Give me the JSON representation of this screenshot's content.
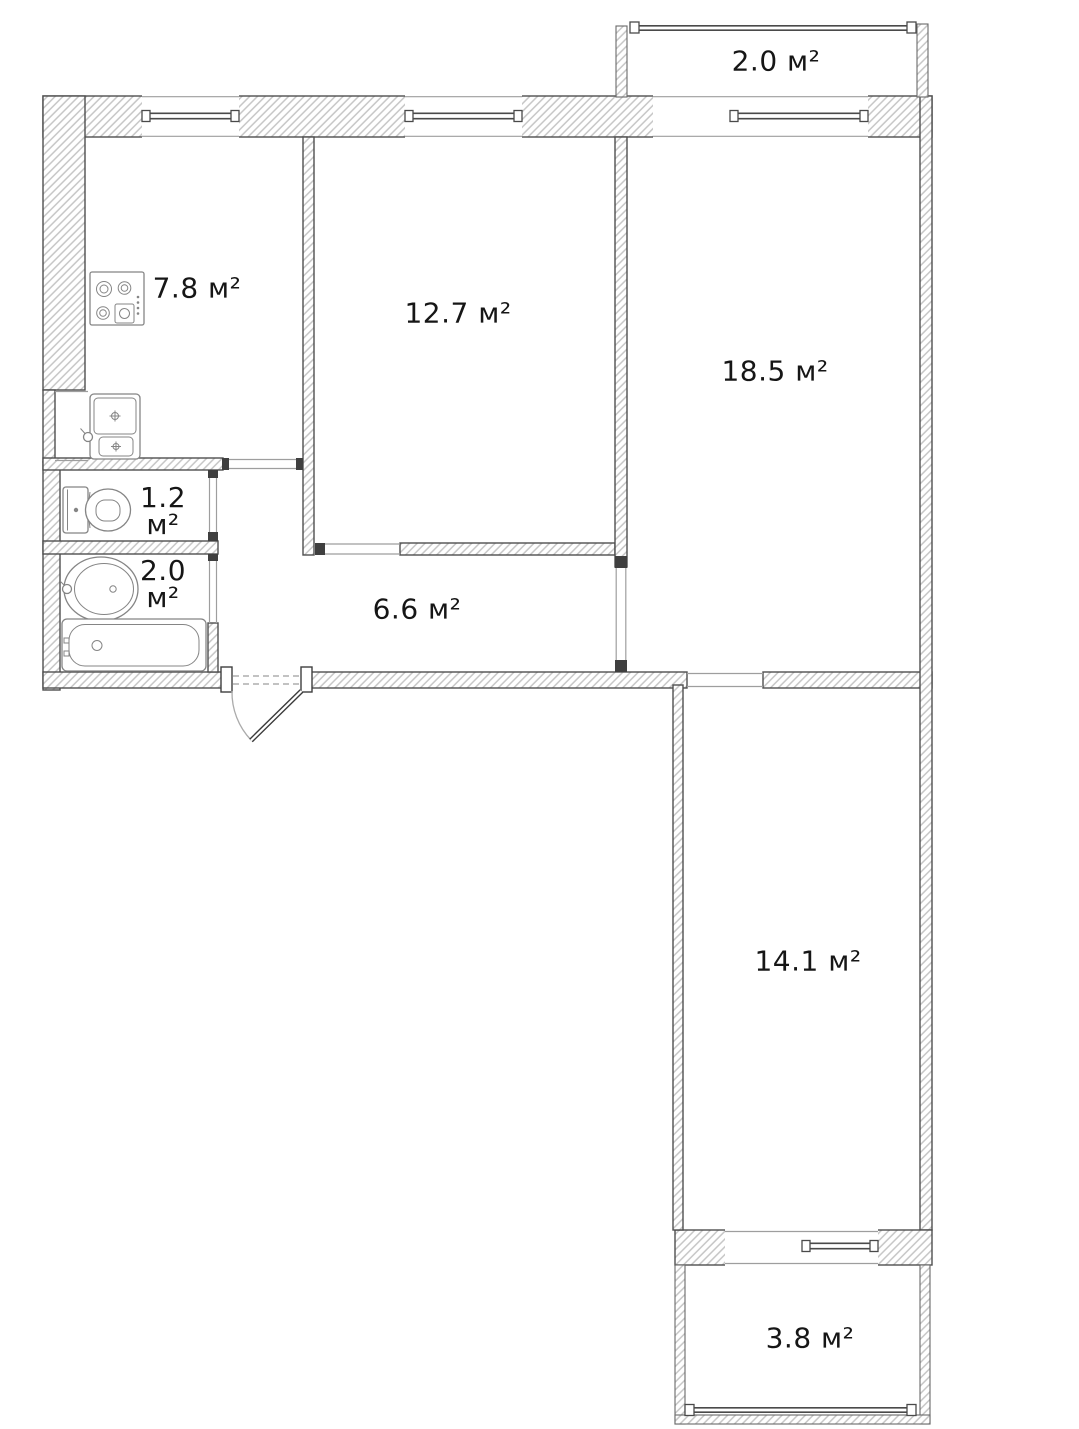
{
  "plan": {
    "type": "apartment-floor-plan",
    "area_unit": "м²",
    "rooms": {
      "balcony_top": {
        "name": "balcony-top",
        "area": "2.0 м²"
      },
      "kitchen": {
        "name": "kitchen",
        "area": "7.8 м²"
      },
      "room_12_7": {
        "name": "room-12-7",
        "area": "12.7 м²"
      },
      "room_18_5": {
        "name": "room-18-5",
        "area": "18.5 м²"
      },
      "wc": {
        "name": "wc",
        "area_value": "1.2",
        "area_unit": "м²"
      },
      "bathroom": {
        "name": "bathroom",
        "area_value": "2.0",
        "area_unit": "м²"
      },
      "hallway": {
        "name": "hallway",
        "area": "6.6 м²"
      },
      "room_14_1": {
        "name": "room-14-1",
        "area": "14.1 м²"
      },
      "balcony_bottom": {
        "name": "balcony-bottom",
        "area": "3.8 м²"
      }
    },
    "fixtures": {
      "stove": "gas-stove-icon",
      "kitchen_sink": "kitchen-sink-icon",
      "toilet": "toilet-icon",
      "washbasin": "washbasin-icon",
      "bathtub": "bathtub-icon",
      "entrance_door": "door-swing-icon"
    },
    "colors": {
      "background": "#ffffff",
      "wall_outline": "#4f4f4f",
      "wall_hatch": "#c6c6c6",
      "label_text": "#161616",
      "fixture_stroke": "#858585",
      "opening_line": "#9e9e9e"
    }
  }
}
